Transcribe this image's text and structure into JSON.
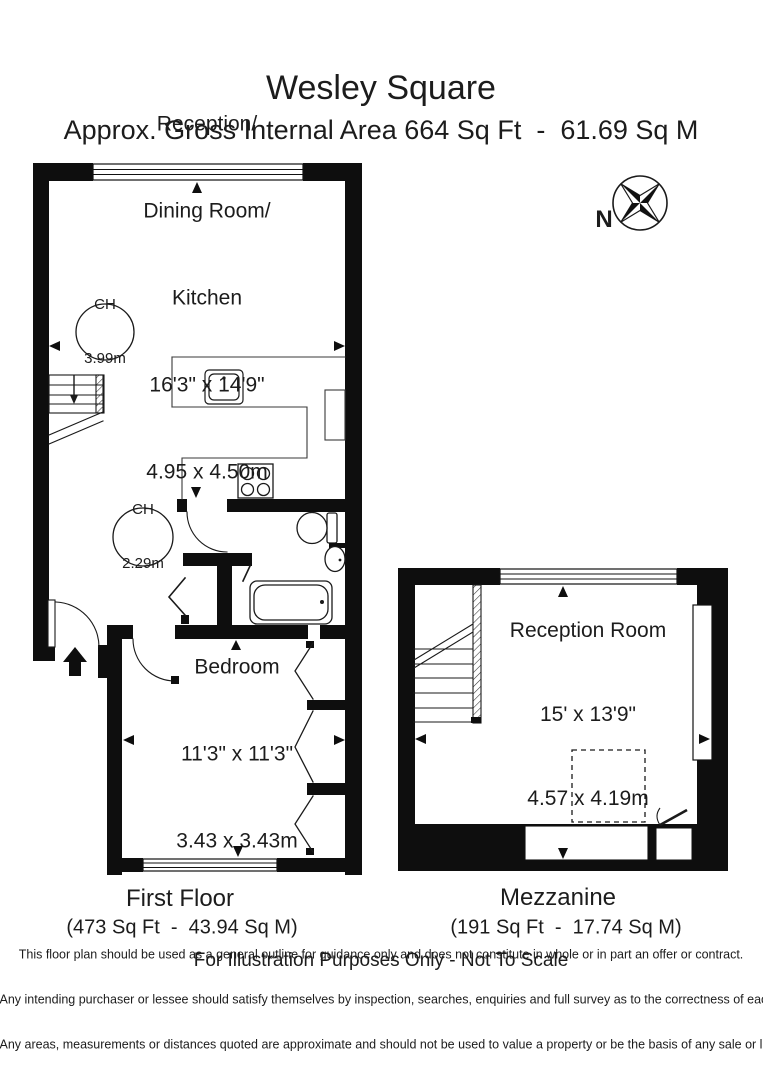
{
  "header": {
    "title": "Wesley Square",
    "subtitle": "Approx. Gross Internal Area 664 Sq Ft  -  61.69 Sq M"
  },
  "compass": {
    "north_label": "N"
  },
  "first_floor": {
    "reception_kitchen": {
      "line1": "Reception/",
      "line2": "Dining Room/",
      "line3": "Kitchen",
      "imperial": "16'3\" x 14'9\"",
      "metric": "4.95 x 4.50m"
    },
    "ceiling_height_upper": {
      "label": "CH",
      "value": "3.99m"
    },
    "ceiling_height_lower": {
      "label": "CH",
      "value": "2.29m"
    },
    "bedroom": {
      "name": "Bedroom",
      "imperial": "11'3\" x 11'3\"",
      "metric": "3.43 x 3.43m"
    },
    "floor_label": "First Floor",
    "floor_area": "(473 Sq Ft  -  43.94 Sq M)"
  },
  "mezzanine": {
    "reception_room": {
      "name": "Reception Room",
      "imperial": "15' x 13'9\"",
      "metric": "4.57 x 4.19m"
    },
    "floor_label": "Mezzanine",
    "floor_area": "(191 Sq Ft  -  17.74 Sq M)"
  },
  "footer": {
    "note": "For Illustration Purposes Only - Not To Scale",
    "disclaimer_line1": "This floor plan should be used as a general outline for guidance only and does not constitute in whole or in part an offer or contract.",
    "disclaimer_line2": "Any intending purchaser or lessee should satisfy themselves by inspection, searches, enquiries and full survey as to the correctness of each statement.",
    "disclaimer_line3": "Any areas, measurements or distances quoted are approximate and should not be used to value a property or be the basis of any sale or let."
  }
}
